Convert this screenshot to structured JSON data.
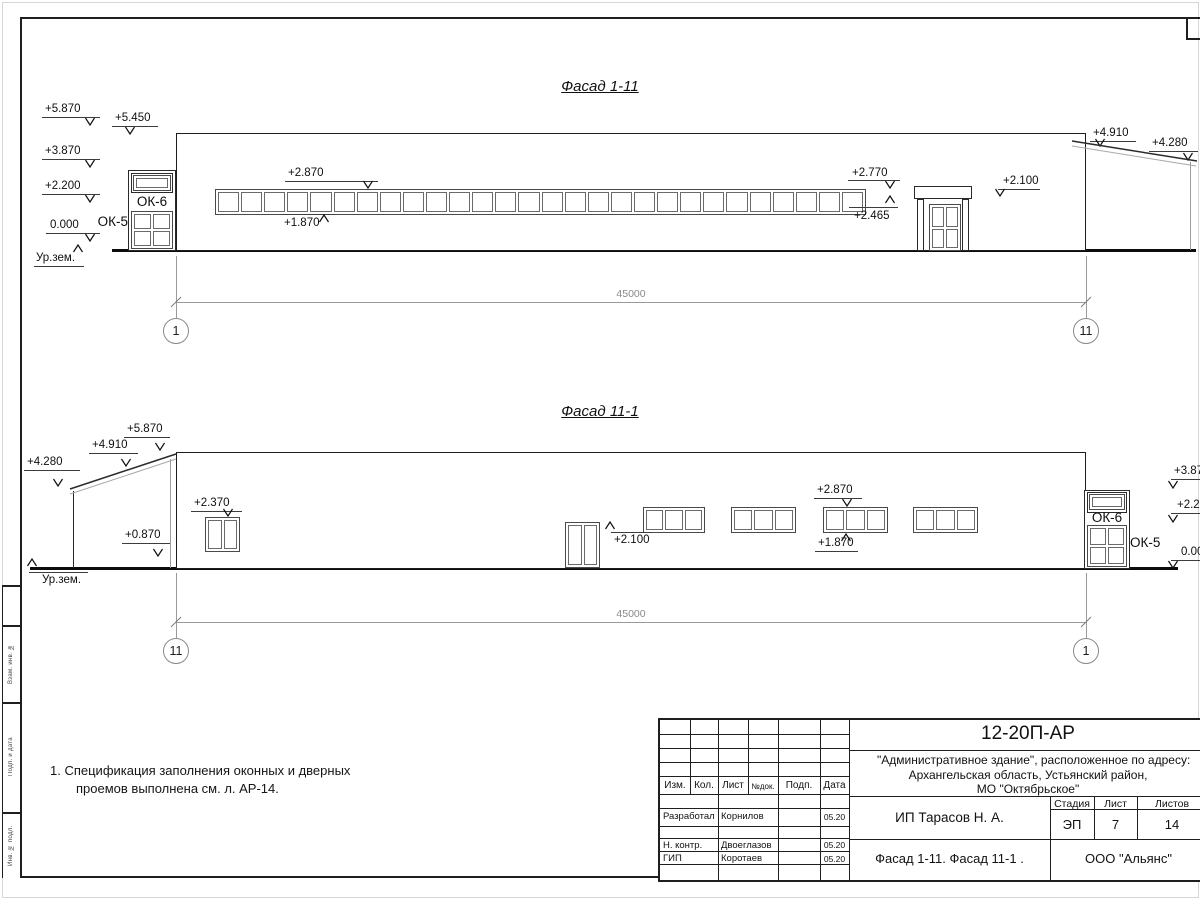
{
  "note": {
    "line1": "1. Спецификация заполнения оконных и дверных",
    "line2": "проемов выполнена см. л. АР-14."
  },
  "side_stamp": {
    "labels": [
      "Взам. инв. №",
      "Подп. и дата",
      "Инв. № подл."
    ]
  },
  "titleblock": {
    "code": "12-20П-АР",
    "address1": "\"Административное здание\", расположенное по адресу:",
    "address2": "Архангельская область, Устьянский район,",
    "address3": "МО \"Октябрьское\"",
    "cols": {
      "izm": "Изм.",
      "kol": "Кол.",
      "list": "Лист",
      "ndoc": "№док.",
      "podp": "Подп.",
      "data": "Дата"
    },
    "rows": [
      {
        "role": "Разработал",
        "name": "Корнилов",
        "date": "05.20"
      },
      {
        "role": "Н. контр.",
        "name": "Двоеглазов",
        "date": "05.20"
      },
      {
        "role": "ГИП",
        "name": "Коротаев",
        "date": "05.20"
      }
    ],
    "stage_label": "Стадия",
    "sheet_label": "Лист",
    "sheets_label": "Листов",
    "stage": "ЭП",
    "sheet": "7",
    "sheets": "14",
    "client": "ИП Тарасов Н. А.",
    "sheet_title": "Фасад 1-11. Фасад 11-1 .",
    "company": "ООО \"Альянс\""
  },
  "facades": [
    {
      "title": "Фасад 1-11",
      "title_y": 78,
      "rects": [
        {
          "x": 176,
          "y": 133,
          "w": 910,
          "h": 118,
          "cls": "wall"
        },
        {
          "x": 128,
          "y": 170,
          "w": 48,
          "h": 81,
          "cls": "box"
        },
        {
          "x": 131,
          "y": 173,
          "w": 42,
          "h": 20,
          "cls": "box"
        },
        {
          "x": 914,
          "y": 186,
          "w": 58,
          "h": 13,
          "cls": "box"
        },
        {
          "x": 917,
          "y": 199,
          "w": 7,
          "h": 52,
          "cls": "box"
        },
        {
          "x": 962,
          "y": 199,
          "w": 7,
          "h": 52,
          "cls": "box"
        }
      ],
      "hlines": [
        {
          "x": 177,
          "y": 139,
          "w": 908,
          "cls": "edge"
        },
        {
          "x": 177,
          "y": 144,
          "w": 908,
          "cls": "edge2"
        },
        {
          "x": 177,
          "y": 154,
          "w": 908,
          "cls": "sid"
        },
        {
          "x": 177,
          "y": 168,
          "w": 908,
          "cls": "sid"
        },
        {
          "x": 177,
          "y": 182,
          "w": 908,
          "cls": "sid"
        },
        {
          "x": 177,
          "y": 196,
          "w": 908,
          "cls": "sid"
        },
        {
          "x": 177,
          "y": 210,
          "w": 908,
          "cls": "sid"
        },
        {
          "x": 177,
          "y": 224,
          "w": 908,
          "cls": "sid"
        },
        {
          "x": 177,
          "y": 238,
          "w": 908,
          "cls": "sid"
        },
        {
          "x": 914,
          "y": 192,
          "w": 58,
          "cls": "edge2"
        },
        {
          "x": 112,
          "y": 249,
          "w": 1084,
          "cls": "heavy"
        }
      ],
      "vlines": [
        {
          "x": 267,
          "y": 145,
          "h": 105,
          "cls": "joint"
        },
        {
          "x": 358,
          "y": 145,
          "h": 105,
          "cls": "joint"
        },
        {
          "x": 449,
          "y": 145,
          "h": 105,
          "cls": "joint"
        },
        {
          "x": 540,
          "y": 145,
          "h": 105,
          "cls": "joint"
        },
        {
          "x": 631,
          "y": 145,
          "h": 105,
          "cls": "joint"
        },
        {
          "x": 722,
          "y": 145,
          "h": 105,
          "cls": "joint"
        },
        {
          "x": 813,
          "y": 145,
          "h": 105,
          "cls": "joint"
        },
        {
          "x": 904,
          "y": 145,
          "h": 105,
          "cls": "joint"
        },
        {
          "x": 995,
          "y": 145,
          "h": 105,
          "cls": "joint"
        },
        {
          "x": 1190,
          "y": 162,
          "h": 88,
          "cls": "edge2"
        }
      ],
      "windows": [
        {
          "x": 215,
          "y": 189,
          "w": 651,
          "h": 26,
          "cols": 28,
          "rows": 1
        },
        {
          "x": 133,
          "y": 175,
          "w": 38,
          "h": 16,
          "cols": 1,
          "rows": 1
        },
        {
          "x": 131,
          "y": 211,
          "w": 42,
          "h": 38,
          "cols": 2,
          "rows": 2
        },
        {
          "x": 929,
          "y": 204,
          "w": 32,
          "h": 47,
          "cols": 2,
          "rows": 2
        }
      ],
      "labels": [
        {
          "t": "ОК-6",
          "x": 131,
          "y": 194,
          "w": 42,
          "a": "center"
        },
        {
          "t": "ОК-5",
          "x": 92,
          "y": 214,
          "w": 36,
          "a": "right"
        }
      ],
      "marks": [
        {
          "t": "+5.870",
          "tx": 45,
          "ty": 103,
          "lx1": 42,
          "lx2": 100,
          "ly": 117,
          "ax": 90,
          "ay": 125,
          "dir": "d"
        },
        {
          "t": "+5.450",
          "tx": 115,
          "ty": 112,
          "lx1": 112,
          "lx2": 158,
          "ly": 126,
          "ax": 130,
          "ay": 134,
          "dir": "d"
        },
        {
          "t": "+3.870",
          "tx": 45,
          "ty": 145,
          "lx1": 42,
          "lx2": 100,
          "ly": 159,
          "ax": 90,
          "ay": 167,
          "dir": "d"
        },
        {
          "t": "+2.200",
          "tx": 45,
          "ty": 180,
          "lx1": 42,
          "lx2": 100,
          "ly": 194,
          "ax": 90,
          "ay": 202,
          "dir": "d"
        },
        {
          "t": "0.000",
          "tx": 50,
          "ty": 219,
          "lx1": 46,
          "lx2": 100,
          "ly": 233,
          "ax": 90,
          "ay": 241,
          "dir": "d"
        },
        {
          "t": "Ур.зем.",
          "tx": 36,
          "ty": 252,
          "lx1": 34,
          "lx2": 84,
          "ly": 266,
          "ax": 78,
          "ay": 245,
          "dir": "u"
        },
        {
          "t": "+2.870",
          "tx": 288,
          "ty": 167,
          "lx1": 285,
          "lx2": 378,
          "ly": 181,
          "ax": 368,
          "ay": 188,
          "dir": "d"
        },
        {
          "t": "+1.870",
          "tx": 284,
          "ty": 217,
          "lx1": 281,
          "lx2": 334,
          "ly": 214,
          "ax": 324,
          "ay": 215,
          "dir": "u"
        },
        {
          "t": "+2.770",
          "tx": 852,
          "ty": 167,
          "lx1": 848,
          "lx2": 900,
          "ly": 180,
          "ax": 890,
          "ay": 188,
          "dir": "d"
        },
        {
          "t": "+2.465",
          "tx": 854,
          "ty": 210,
          "lx1": 849,
          "lx2": 898,
          "ly": 207,
          "ax": 890,
          "ay": 196,
          "dir": "u"
        },
        {
          "t": "+2.100",
          "tx": 1003,
          "ty": 175,
          "lx1": 998,
          "lx2": 1040,
          "ly": 189,
          "ax": 1000,
          "ay": 196,
          "dir": "d"
        },
        {
          "t": "+4.910",
          "tx": 1093,
          "ty": 127,
          "lx1": 1090,
          "lx2": 1136,
          "ly": 141,
          "ax": 1100,
          "ay": 146,
          "dir": "d"
        },
        {
          "t": "+4.280",
          "tx": 1152,
          "ty": 137,
          "lx1": 1149,
          "lx2": 1198,
          "ly": 151,
          "ax": 1188,
          "ay": 160,
          "dir": "d"
        }
      ],
      "slopes": [
        [
          1072,
          141,
          1197,
          161,
          "edge"
        ],
        [
          1072,
          146,
          1196,
          166,
          "thin"
        ]
      ],
      "dim": {
        "y": 302,
        "x1": 176,
        "x2": 1086,
        "label": "45000",
        "label_y": 288,
        "ext_y1": 256,
        "ext_y2": 318,
        "cy": 331,
        "circles": [
          {
            "t": "1",
            "cx": 176
          },
          {
            "t": "11",
            "cx": 1086
          }
        ]
      }
    },
    {
      "title": "Фасад 11-1",
      "title_y": 403,
      "rects": [
        {
          "x": 176,
          "y": 452,
          "w": 910,
          "h": 117,
          "cls": "wall"
        },
        {
          "x": 1084,
          "y": 490,
          "w": 46,
          "h": 79,
          "cls": "box"
        },
        {
          "x": 1087,
          "y": 492,
          "w": 40,
          "h": 21,
          "cls": "box"
        }
      ],
      "hlines": [
        {
          "x": 177,
          "y": 458,
          "w": 908,
          "cls": "edge"
        },
        {
          "x": 177,
          "y": 463,
          "w": 908,
          "cls": "edge2"
        },
        {
          "x": 177,
          "y": 472,
          "w": 908,
          "cls": "sid"
        },
        {
          "x": 177,
          "y": 486,
          "w": 908,
          "cls": "sid"
        },
        {
          "x": 177,
          "y": 500,
          "w": 908,
          "cls": "sid"
        },
        {
          "x": 177,
          "y": 514,
          "w": 908,
          "cls": "sid"
        },
        {
          "x": 177,
          "y": 528,
          "w": 908,
          "cls": "sid"
        },
        {
          "x": 177,
          "y": 542,
          "w": 908,
          "cls": "sid"
        },
        {
          "x": 177,
          "y": 556,
          "w": 908,
          "cls": "sid"
        },
        {
          "x": 556,
          "y": 566,
          "w": 52,
          "cls": "edge"
        },
        {
          "x": 30,
          "y": 567,
          "w": 1148,
          "cls": "heavy"
        }
      ],
      "vlines": [
        {
          "x": 267,
          "y": 464,
          "h": 104,
          "cls": "joint"
        },
        {
          "x": 358,
          "y": 464,
          "h": 104,
          "cls": "joint"
        },
        {
          "x": 449,
          "y": 464,
          "h": 104,
          "cls": "joint"
        },
        {
          "x": 540,
          "y": 464,
          "h": 104,
          "cls": "joint"
        },
        {
          "x": 631,
          "y": 464,
          "h": 104,
          "cls": "joint"
        },
        {
          "x": 722,
          "y": 464,
          "h": 104,
          "cls": "joint"
        },
        {
          "x": 813,
          "y": 464,
          "h": 104,
          "cls": "joint"
        },
        {
          "x": 904,
          "y": 464,
          "h": 104,
          "cls": "joint"
        },
        {
          "x": 995,
          "y": 464,
          "h": 104,
          "cls": "joint"
        },
        {
          "x": 73,
          "y": 491,
          "h": 77,
          "cls": "edge"
        },
        {
          "x": 170,
          "y": 459,
          "h": 109,
          "cls": "edge2"
        }
      ],
      "windows": [
        {
          "x": 205,
          "y": 517,
          "w": 35,
          "h": 35,
          "cols": 2,
          "rows": 1
        },
        {
          "x": 643,
          "y": 507,
          "w": 62,
          "h": 26,
          "cols": 3,
          "rows": 1
        },
        {
          "x": 731,
          "y": 507,
          "w": 65,
          "h": 26,
          "cols": 3,
          "rows": 1
        },
        {
          "x": 823,
          "y": 507,
          "w": 65,
          "h": 26,
          "cols": 3,
          "rows": 1
        },
        {
          "x": 913,
          "y": 507,
          "w": 65,
          "h": 26,
          "cols": 3,
          "rows": 1
        },
        {
          "x": 1089,
          "y": 494,
          "w": 36,
          "h": 16,
          "cols": 1,
          "rows": 1
        },
        {
          "x": 1087,
          "y": 525,
          "w": 40,
          "h": 42,
          "cols": 2,
          "rows": 2
        },
        {
          "x": 565,
          "y": 522,
          "w": 35,
          "h": 46,
          "cols": 2,
          "rows": 1
        }
      ],
      "labels": [
        {
          "t": "ОК-6",
          "x": 1087,
          "y": 510,
          "w": 40,
          "a": "center"
        },
        {
          "t": "ОК-5",
          "x": 1130,
          "y": 535,
          "w": 46,
          "a": "left"
        }
      ],
      "marks": [
        {
          "t": "+5.870",
          "tx": 127,
          "ty": 423,
          "lx1": 124,
          "lx2": 170,
          "ly": 437,
          "ax": 160,
          "ay": 450,
          "dir": "d"
        },
        {
          "t": "+4.910",
          "tx": 92,
          "ty": 439,
          "lx1": 89,
          "lx2": 138,
          "ly": 453,
          "ax": 126,
          "ay": 466,
          "dir": "d"
        },
        {
          "t": "+4.280",
          "tx": 27,
          "ty": 456,
          "lx1": 24,
          "lx2": 80,
          "ly": 470,
          "ax": 58,
          "ay": 486,
          "dir": "d"
        },
        {
          "t": "+0.870",
          "tx": 125,
          "ty": 529,
          "lx1": 122,
          "lx2": 170,
          "ly": 543,
          "ax": 158,
          "ay": 556,
          "dir": "d"
        },
        {
          "t": "Ур.зем.",
          "tx": 42,
          "ty": 574,
          "lx1": 29,
          "lx2": 88,
          "ly": 572,
          "ax": 32,
          "ay": 559,
          "dir": "u"
        },
        {
          "t": "+2.370",
          "tx": 194,
          "ty": 497,
          "lx1": 191,
          "lx2": 242,
          "ly": 511,
          "ax": 228,
          "ay": 516,
          "dir": "d"
        },
        {
          "t": "+2.100",
          "tx": 614,
          "ty": 534,
          "lx1": 611,
          "lx2": 652,
          "ly": 532,
          "ax": 610,
          "ay": 522,
          "dir": "u"
        },
        {
          "t": "+2.870",
          "tx": 817,
          "ty": 484,
          "lx1": 814,
          "lx2": 862,
          "ly": 498,
          "ax": 847,
          "ay": 506,
          "dir": "d"
        },
        {
          "t": "+1.870",
          "tx": 818,
          "ty": 537,
          "lx1": 815,
          "lx2": 858,
          "ly": 551,
          "ax": 846,
          "ay": 534,
          "dir": "u"
        },
        {
          "t": "+3.870",
          "tx": 1174,
          "ty": 465,
          "lx1": 1171,
          "lx2": 1205,
          "ly": 479,
          "ax": 1173,
          "ay": 488,
          "dir": "d"
        },
        {
          "t": "+2.200",
          "tx": 1177,
          "ty": 499,
          "lx1": 1171,
          "lx2": 1205,
          "ly": 513,
          "ax": 1173,
          "ay": 522,
          "dir": "d"
        },
        {
          "t": "0.000",
          "tx": 1181,
          "ty": 546,
          "lx1": 1171,
          "lx2": 1205,
          "ly": 560,
          "ax": 1173,
          "ay": 568,
          "dir": "d"
        }
      ],
      "slopes": [
        [
          70,
          489,
          176,
          454,
          "edge"
        ],
        [
          70,
          494,
          176,
          459,
          "thin"
        ]
      ],
      "dim": {
        "y": 622,
        "x1": 176,
        "x2": 1086,
        "label": "45000",
        "label_y": 608,
        "ext_y1": 573,
        "ext_y2": 638,
        "cy": 651,
        "circles": [
          {
            "t": "11",
            "cx": 176
          },
          {
            "t": "1",
            "cx": 1086
          }
        ]
      }
    }
  ]
}
